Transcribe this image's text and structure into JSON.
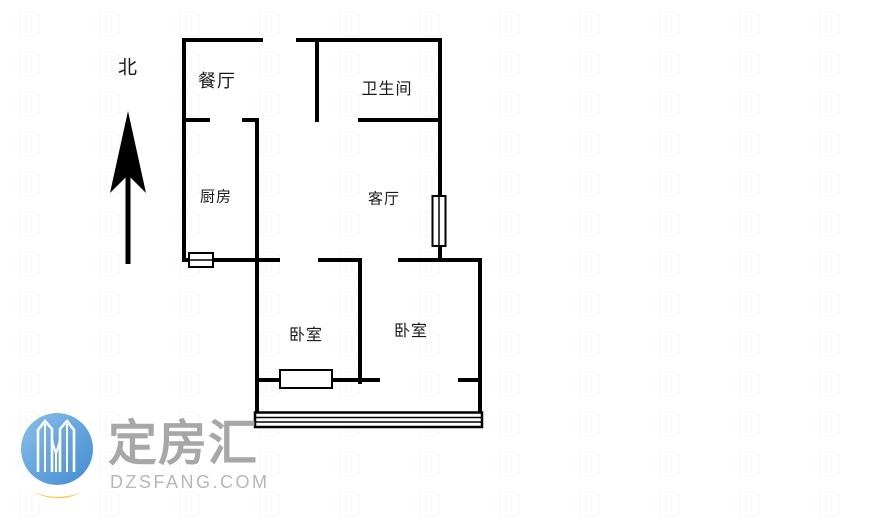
{
  "compass": {
    "label": "北"
  },
  "rooms": {
    "dining": "餐厅",
    "bathroom": "卫生间",
    "kitchen": "厨房",
    "living": "客厅",
    "bedroom_left": "卧室",
    "bedroom_right": "卧室"
  },
  "watermark": {
    "brand": "定房汇",
    "domain": "DZSFANG.COM"
  },
  "colors": {
    "wall": "#000000",
    "logo_blue_light": "#76b5e7",
    "logo_blue": "#2f7fcd",
    "logo_red": "#e84a5c",
    "logo_yellow": "#f3c74b",
    "brand_text": "#9c9c9c",
    "domain_text": "#b7b7b7"
  }
}
